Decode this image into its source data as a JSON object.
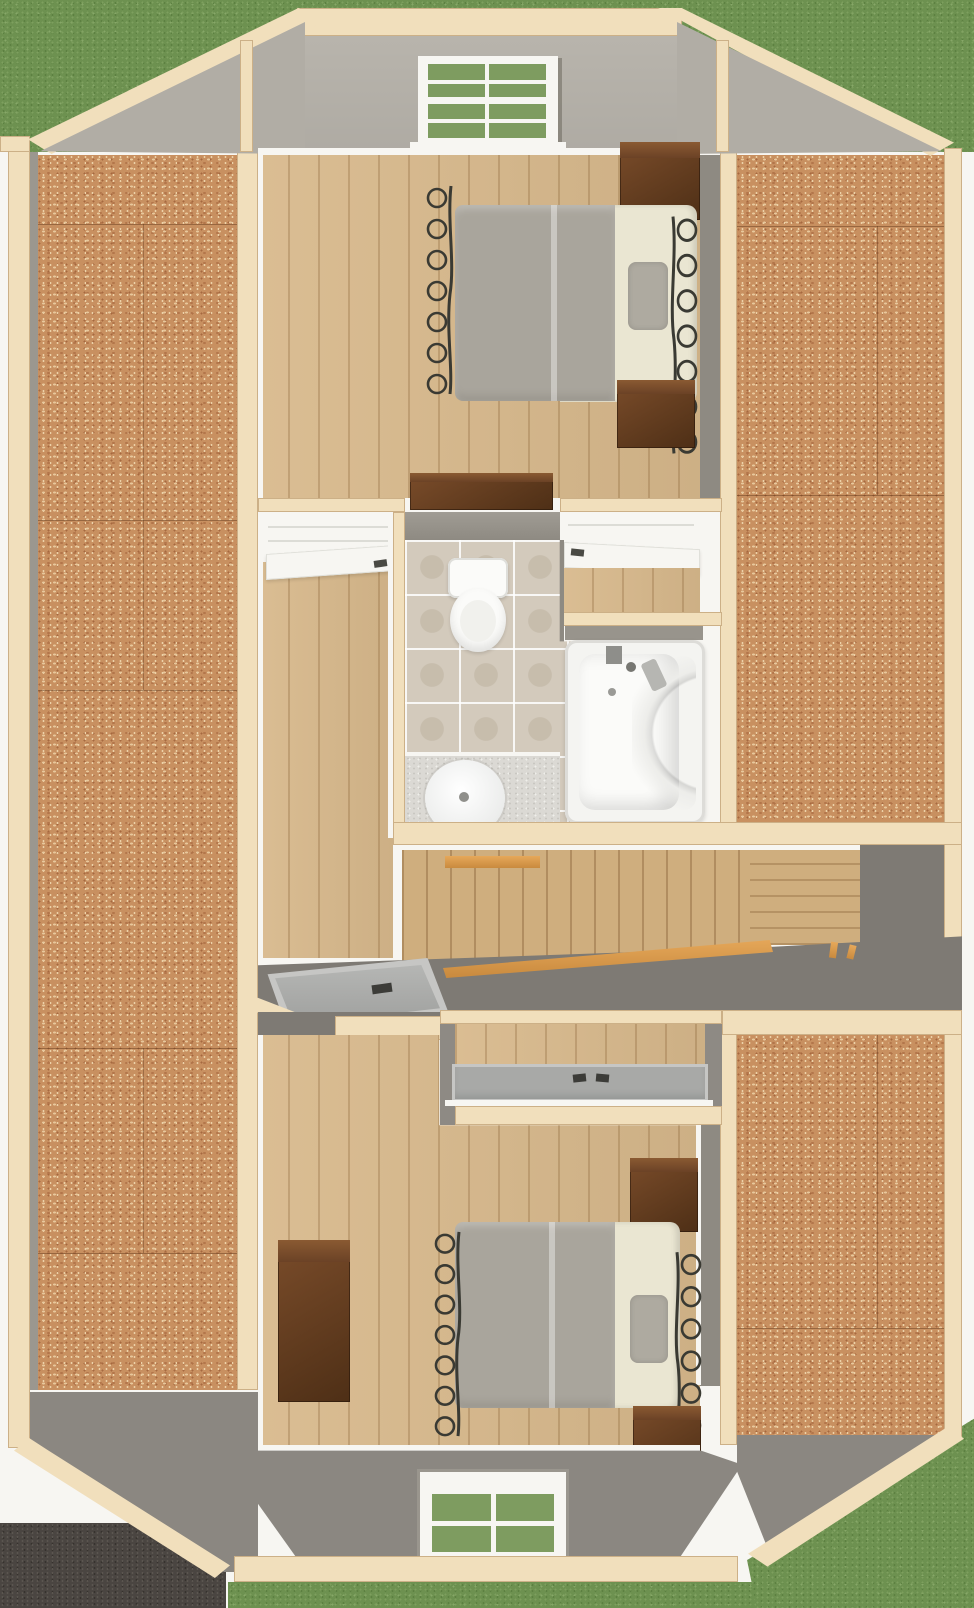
{
  "scene": {
    "view": "top-down-3d-dollhouse-floorplan-render",
    "level": "upper-floor",
    "areas": [
      {
        "name": "attic-left",
        "floor": "osb-subfloor"
      },
      {
        "name": "attic-right",
        "floor": "osb-subfloor"
      },
      {
        "name": "bedroom-top",
        "floor": "light-wood-plank",
        "furniture": [
          "iron-frame-bed",
          "nightstand",
          "dresser",
          "low-media-chest"
        ]
      },
      {
        "name": "closet-left",
        "door": "white-swing-open"
      },
      {
        "name": "closet-right",
        "door": "white-swing-open"
      },
      {
        "name": "bathroom",
        "floor": "stone-tile",
        "fixtures": [
          "toilet",
          "vanity-sink",
          "corner-bathtub"
        ]
      },
      {
        "name": "hallway",
        "floor": "light-wood-plank"
      },
      {
        "name": "stairwell",
        "features": [
          "wood-stairs",
          "orange-handrail",
          "wood-landing",
          "balusters"
        ]
      },
      {
        "name": "bedroom-bottom",
        "floor": "light-wood-plank",
        "furniture": [
          "iron-frame-bed",
          "nightstand",
          "dresser"
        ]
      },
      {
        "name": "exterior",
        "features": [
          "grass-lawn",
          "asphalt-pad",
          "skylight-left",
          "skylight-center",
          "gable-window-top",
          "gable-window-bottom"
        ]
      }
    ],
    "windows": {
      "top": {
        "pane_cols": 2,
        "pane_rows": 4,
        "view_through": "grass"
      },
      "bottom": {
        "pane_cols": 2,
        "pane_rows": 2,
        "view_through": "grass"
      }
    }
  },
  "colors": {
    "white": "#f7f6f2",
    "grass": "#6d9150",
    "asphalt": "#4a4541",
    "frame": "#f1dfbc",
    "frameEdge": "#c9a878",
    "gable": "#b8b4ac",
    "slope": "#b1ada5",
    "roof": "#7e7a74",
    "roofLight": "#8b8781",
    "face": "#8e8a82",
    "osb": "#c89060",
    "wood": "#d8b98c",
    "stair": "#cfae7e",
    "rail": "#e6a85a",
    "tile": "#d3cabc",
    "granite": "#dbd9d4",
    "fixture": "#fbfbf9",
    "darkwood": "#5e3a20",
    "iron": "#3a3a33",
    "blanket": "#a9a59c",
    "linen": "#eae6d2",
    "pillow": "#aeaaa0",
    "skylight": "#a8a9a7",
    "pane": "#7e9c60"
  }
}
